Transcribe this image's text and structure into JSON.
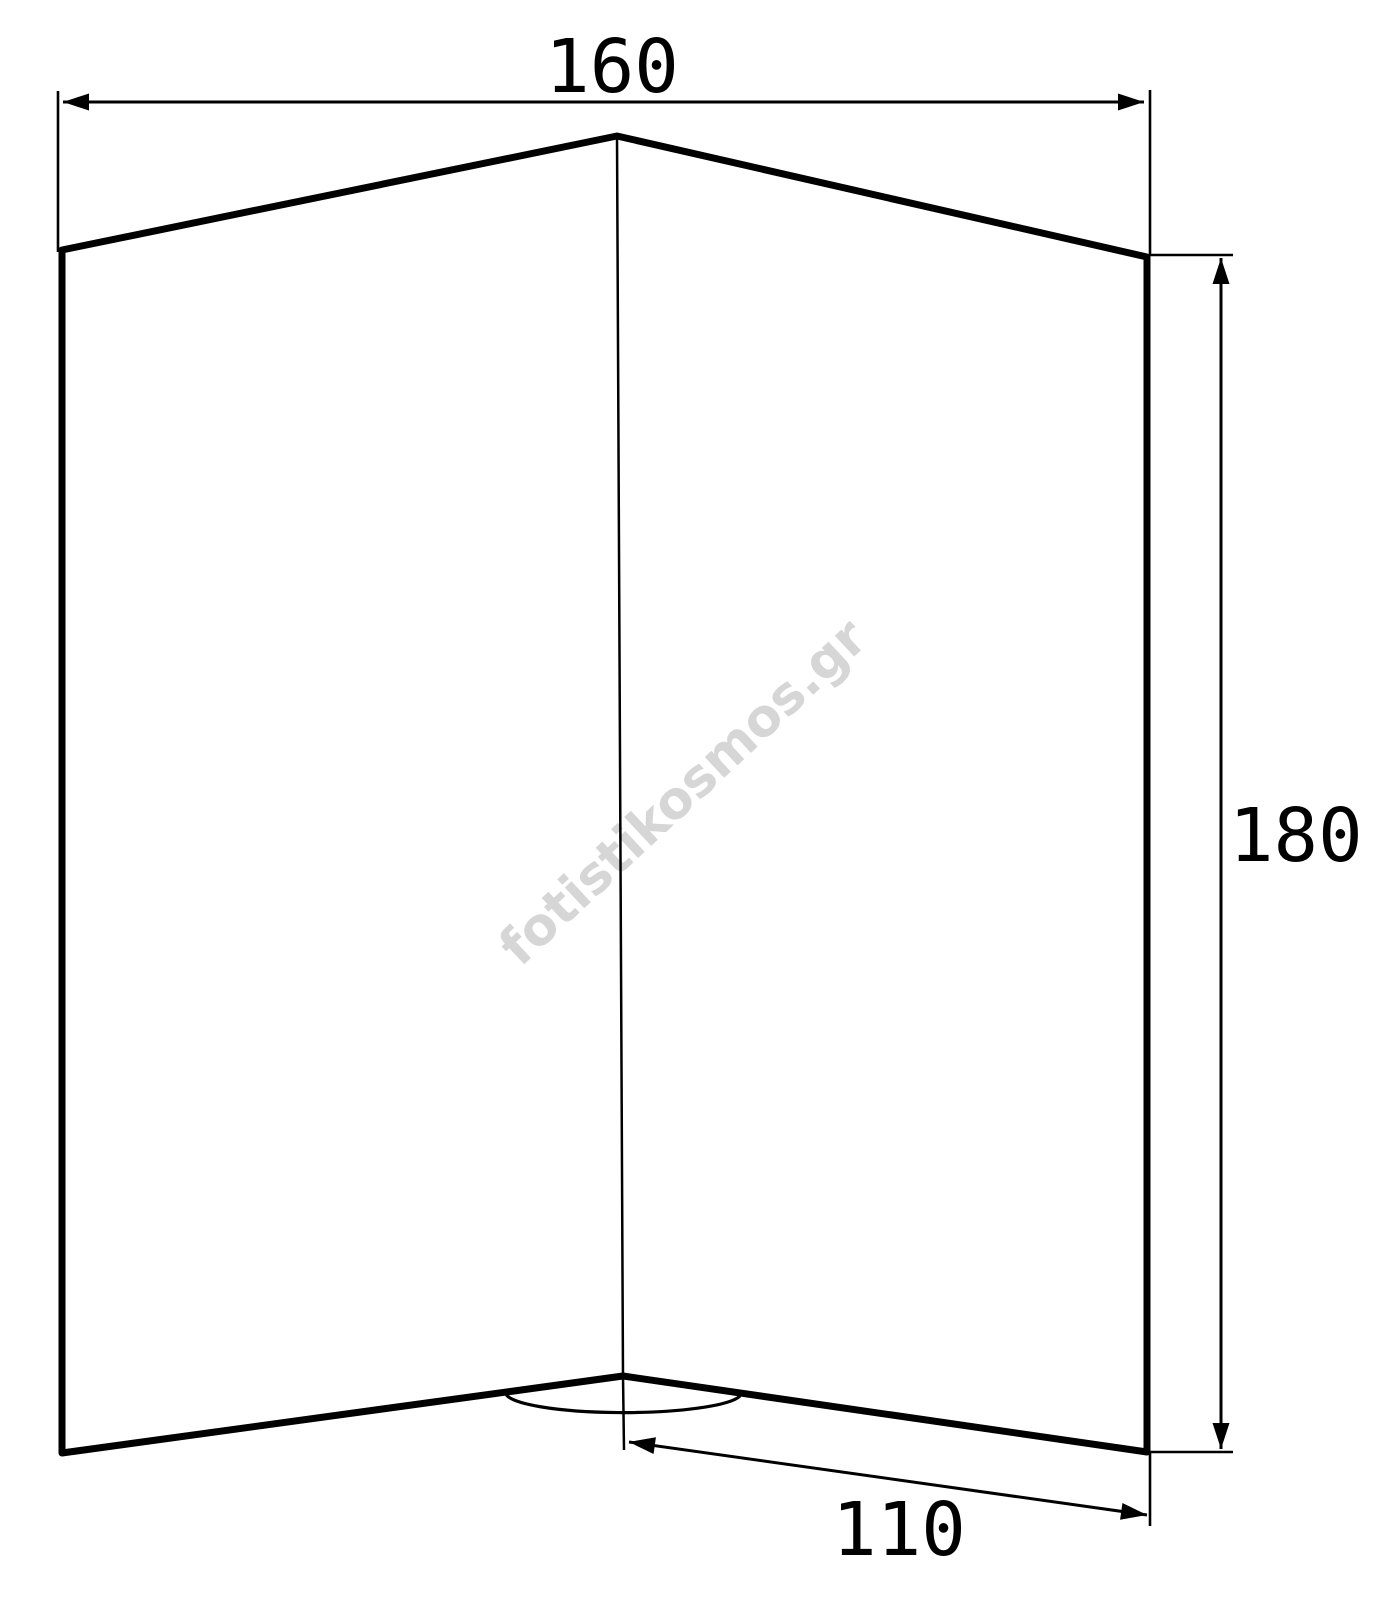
{
  "drawing": {
    "watermark": "fotistikosmos.gr",
    "dimensions": {
      "top_width": "160",
      "right_height": "180",
      "bottom_depth": "110"
    },
    "colors": {
      "line": "#000000",
      "watermark": "#d6d6d6",
      "background": "#ffffff"
    }
  }
}
